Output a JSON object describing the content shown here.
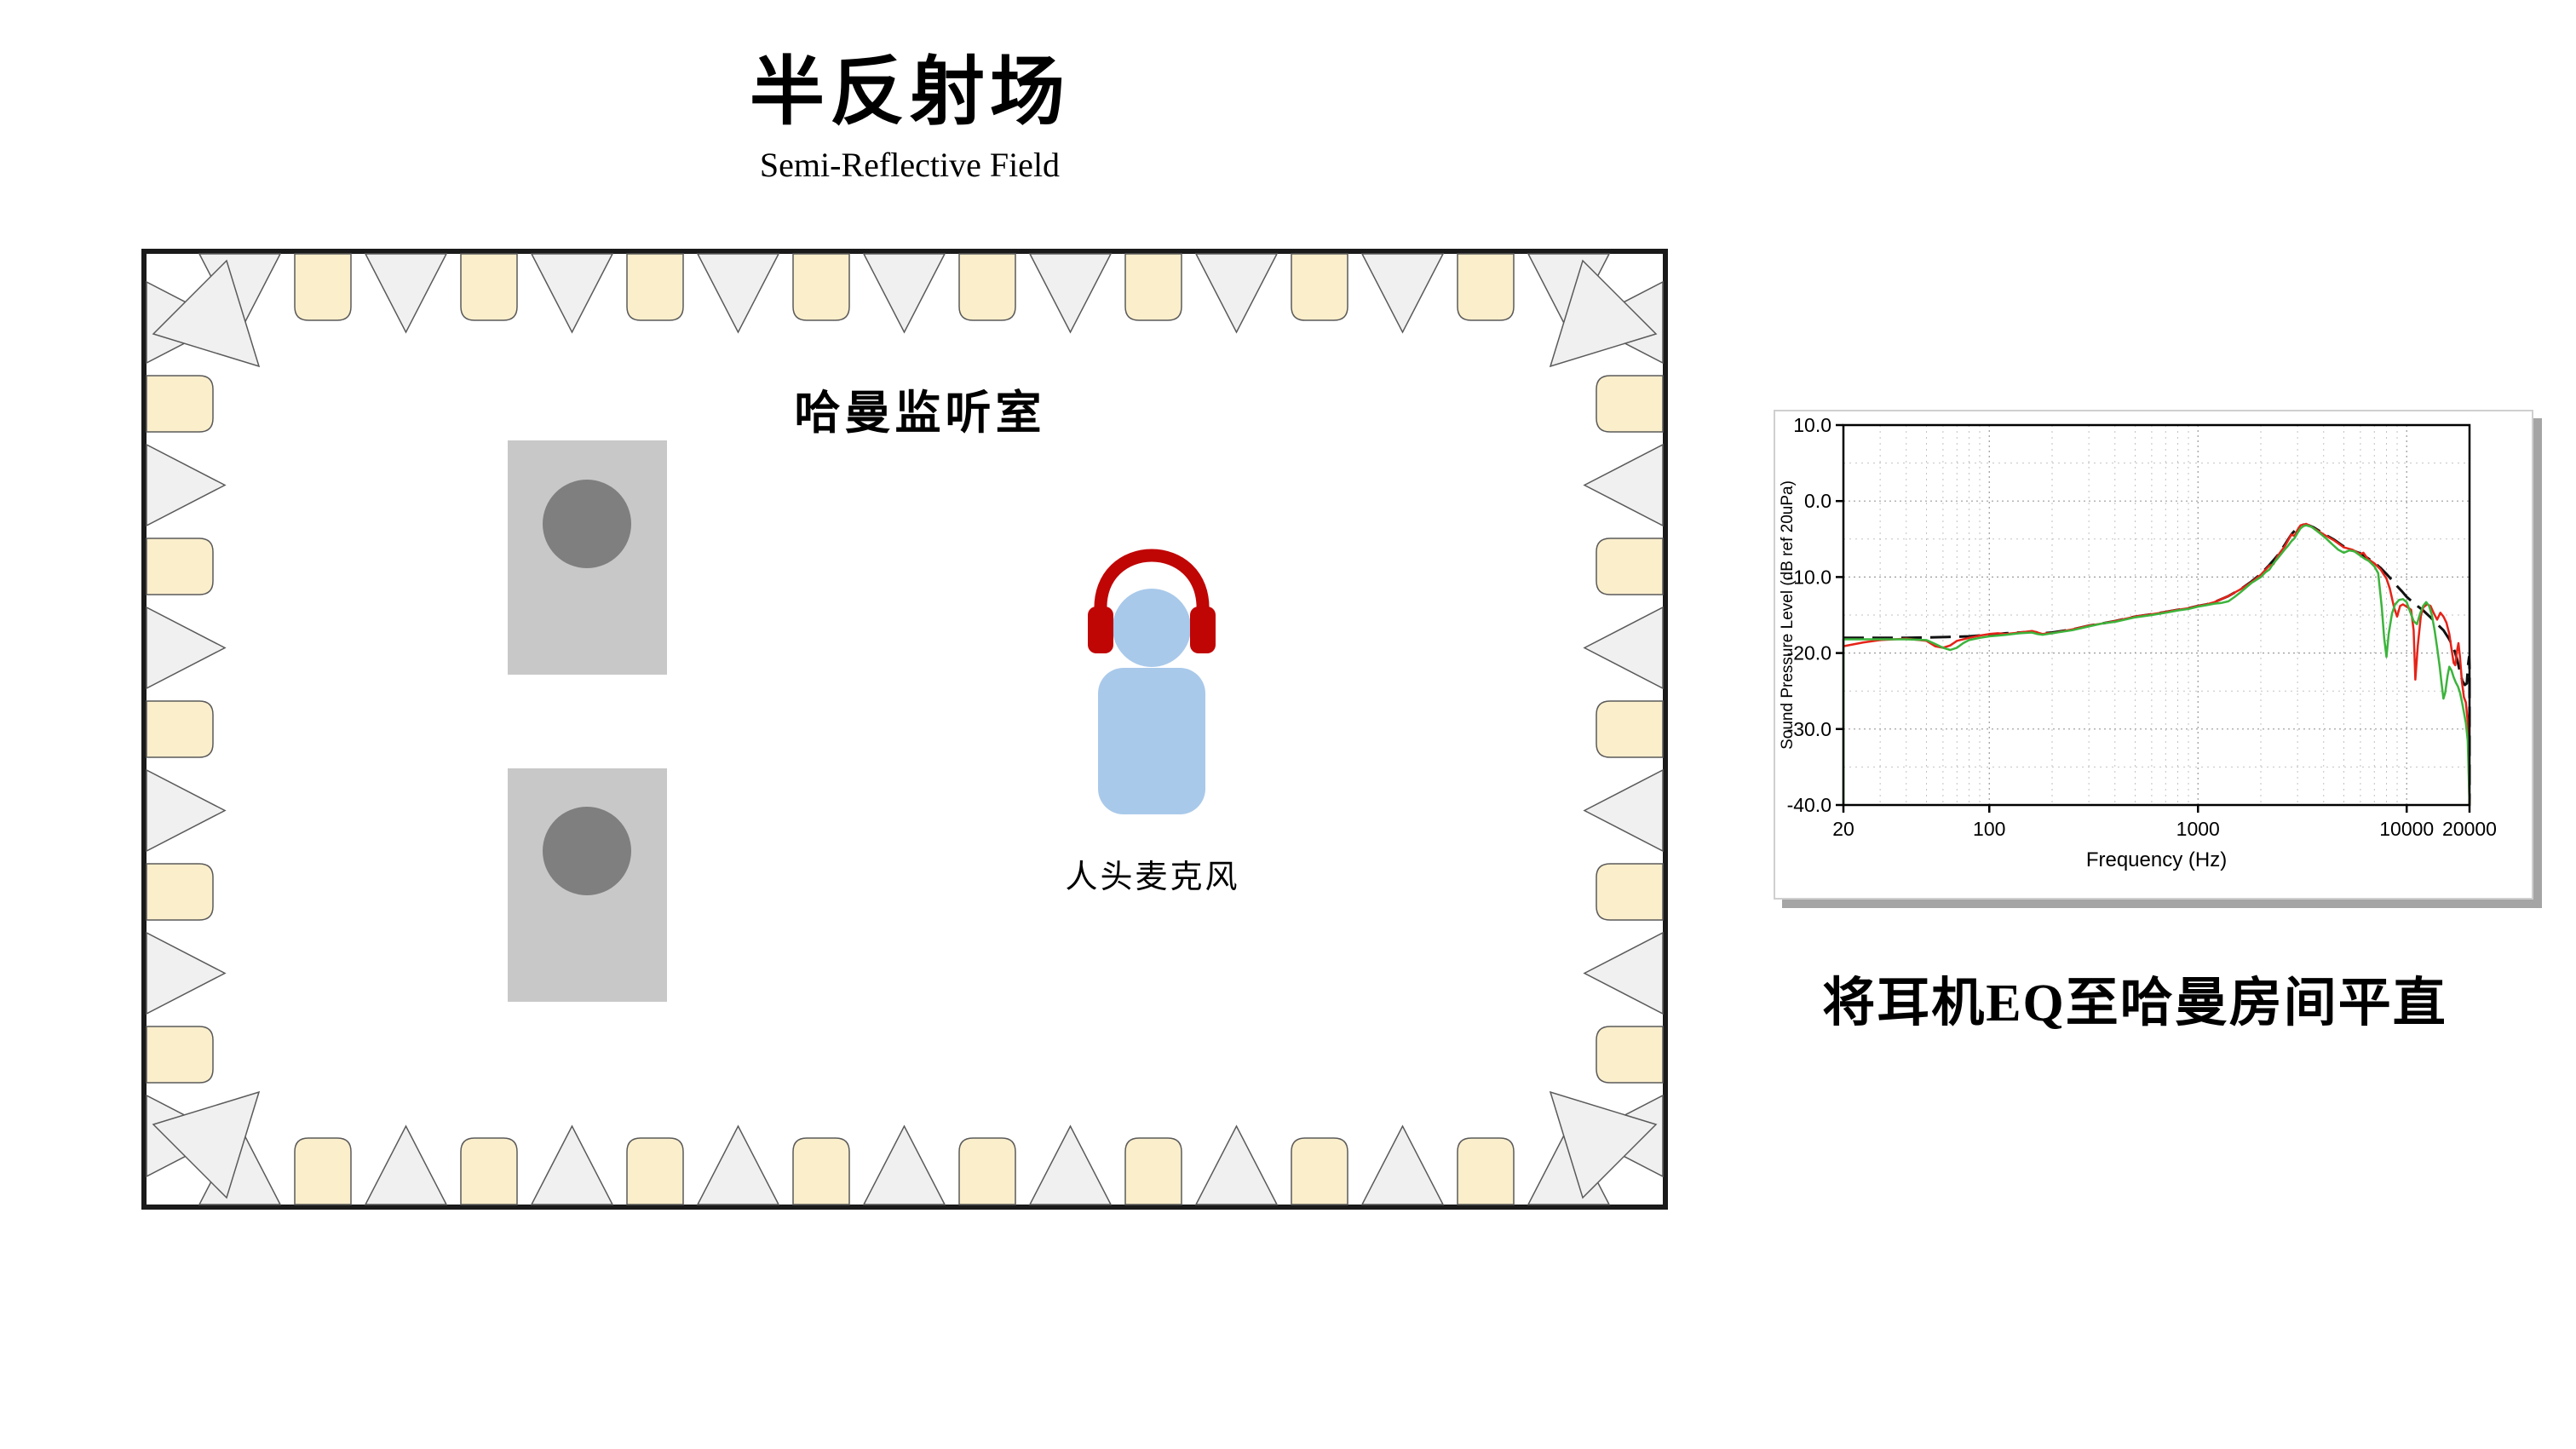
{
  "title": {
    "zh": "半反射场",
    "en": "Semi-Reflective Field"
  },
  "room": {
    "label": "哈曼监听室",
    "mic_label": "人头麦克风",
    "speaker_count": 2,
    "treatment": {
      "top_wedges": 9,
      "top_absorbers": 8,
      "bottom_wedges": 9,
      "bottom_absorbers": 8,
      "left_wedges": 6,
      "left_absorbers": 5,
      "right_wedges": 6,
      "right_absorbers": 5,
      "corner_wedges": 4
    },
    "colors": {
      "wall": "#1a1a1a",
      "wedge_fill": "#f0f0f0",
      "wedge_stroke": "#5a5a5a",
      "absorber_fill": "#fbeecb",
      "speaker_body": "#c8c8c8",
      "speaker_cone": "#7f7f7f",
      "person_blue": "#a9c9ea",
      "headphone_red": "#c00505"
    }
  },
  "chart_caption": "将耳机EQ至哈曼房间平直",
  "chart_data": {
    "type": "line",
    "title": "",
    "xlabel": "Frequency (Hz)",
    "ylabel": "Sound Pressure Level (dB ref 20uPa)",
    "x_scale": "log",
    "xlim": [
      20,
      20000
    ],
    "ylim": [
      -40,
      10
    ],
    "xtick_values": [
      20,
      100,
      1000,
      10000,
      20000
    ],
    "xtick_labels": [
      "20",
      "100",
      "1000",
      "10000",
      "20000"
    ],
    "ytick_values": [
      10,
      0,
      -10,
      -20,
      -30,
      -40
    ],
    "ytick_labels": [
      "10.0",
      "0.0",
      "-10.0",
      "-20.0",
      "-30.0",
      "-40.0"
    ],
    "grid": true,
    "legend": false,
    "series": [
      {
        "name": "target-black-dashed",
        "color": "#111111",
        "style": "dashed",
        "width": 3,
        "points": [
          [
            20,
            -18
          ],
          [
            40,
            -18
          ],
          [
            60,
            -17.9
          ],
          [
            80,
            -17.8
          ],
          [
            100,
            -17.6
          ],
          [
            120,
            -17.4
          ],
          [
            140,
            -17.3
          ],
          [
            160,
            -17.2
          ],
          [
            180,
            -17.4
          ],
          [
            200,
            -17.3
          ],
          [
            250,
            -16.9
          ],
          [
            300,
            -16.4
          ],
          [
            350,
            -16.1
          ],
          [
            400,
            -15.8
          ],
          [
            500,
            -15.2
          ],
          [
            600,
            -14.9
          ],
          [
            700,
            -14.6
          ],
          [
            800,
            -14.3
          ],
          [
            900,
            -14.1
          ],
          [
            1000,
            -13.8
          ],
          [
            1100,
            -13.6
          ],
          [
            1200,
            -13.3
          ],
          [
            1400,
            -12.5
          ],
          [
            1600,
            -11.6
          ],
          [
            1800,
            -10.6
          ],
          [
            2000,
            -9.6
          ],
          [
            2200,
            -8.4
          ],
          [
            2400,
            -7.2
          ],
          [
            2600,
            -5.8
          ],
          [
            2800,
            -4.4
          ],
          [
            3000,
            -3.5
          ],
          [
            3200,
            -3.1
          ],
          [
            3400,
            -3.2
          ],
          [
            3600,
            -3.5
          ],
          [
            3800,
            -3.9
          ],
          [
            4000,
            -4.3
          ],
          [
            4500,
            -5.1
          ],
          [
            5000,
            -6
          ],
          [
            5500,
            -6.5
          ],
          [
            6000,
            -6.9
          ],
          [
            6500,
            -7.5
          ],
          [
            7000,
            -8.1
          ],
          [
            7500,
            -8.8
          ],
          [
            8000,
            -9.6
          ],
          [
            8500,
            -10.4
          ],
          [
            9000,
            -11.2
          ],
          [
            9500,
            -11.9
          ],
          [
            10000,
            -12.6
          ],
          [
            11000,
            -13.6
          ],
          [
            12000,
            -14.4
          ],
          [
            13000,
            -15.3
          ],
          [
            14000,
            -16.2
          ],
          [
            15000,
            -17
          ],
          [
            16000,
            -18.2
          ],
          [
            17000,
            -19.8
          ],
          [
            17500,
            -21
          ],
          [
            18000,
            -22.5
          ],
          [
            18500,
            -23.7
          ],
          [
            19000,
            -24.2
          ],
          [
            19400,
            -24
          ],
          [
            19700,
            -21.5
          ],
          [
            19900,
            -20.5
          ],
          [
            20000,
            -22
          ],
          [
            20000,
            -40
          ]
        ]
      },
      {
        "name": "measured-red",
        "color": "#e52318",
        "style": "solid",
        "width": 2.5,
        "points": [
          [
            20,
            -19.1
          ],
          [
            25,
            -18.6
          ],
          [
            30,
            -18.3
          ],
          [
            40,
            -18.1
          ],
          [
            50,
            -18.4
          ],
          [
            55,
            -19.1
          ],
          [
            60,
            -19.3
          ],
          [
            65,
            -19
          ],
          [
            70,
            -18.4
          ],
          [
            80,
            -18
          ],
          [
            90,
            -17.7
          ],
          [
            100,
            -17.5
          ],
          [
            110,
            -17.4
          ],
          [
            120,
            -17.5
          ],
          [
            130,
            -17.4
          ],
          [
            140,
            -17.3
          ],
          [
            150,
            -17.2
          ],
          [
            160,
            -17.1
          ],
          [
            170,
            -17.3
          ],
          [
            180,
            -17.5
          ],
          [
            190,
            -17.4
          ],
          [
            200,
            -17.4
          ],
          [
            250,
            -16.9
          ],
          [
            300,
            -16.4
          ],
          [
            350,
            -16.1
          ],
          [
            400,
            -15.8
          ],
          [
            500,
            -15.2
          ],
          [
            600,
            -14.9
          ],
          [
            700,
            -14.6
          ],
          [
            800,
            -14.3
          ],
          [
            900,
            -14.1
          ],
          [
            1000,
            -13.8
          ],
          [
            1100,
            -13.6
          ],
          [
            1200,
            -13.3
          ],
          [
            1400,
            -12.5
          ],
          [
            1600,
            -11.6
          ],
          [
            1800,
            -10.7
          ],
          [
            2000,
            -9.7
          ],
          [
            2200,
            -8.5
          ],
          [
            2300,
            -8.3
          ],
          [
            2400,
            -7.3
          ],
          [
            2500,
            -6.6
          ],
          [
            2600,
            -6
          ],
          [
            2700,
            -5.2
          ],
          [
            2800,
            -4.4
          ],
          [
            2900,
            -4.6
          ],
          [
            3000,
            -3.8
          ],
          [
            3100,
            -3.2
          ],
          [
            3200,
            -3.1
          ],
          [
            3300,
            -3
          ],
          [
            3400,
            -3.2
          ],
          [
            3600,
            -3.6
          ],
          [
            3800,
            -4
          ],
          [
            4000,
            -4.4
          ],
          [
            4500,
            -5.2
          ],
          [
            5000,
            -6.1
          ],
          [
            5500,
            -6.4
          ],
          [
            6000,
            -7
          ],
          [
            6200,
            -6.8
          ],
          [
            6500,
            -7.6
          ],
          [
            7000,
            -8.2
          ],
          [
            7500,
            -9
          ],
          [
            8000,
            -10.2
          ],
          [
            8300,
            -11.5
          ],
          [
            8700,
            -14
          ],
          [
            9000,
            -15.2
          ],
          [
            9300,
            -13.8
          ],
          [
            9600,
            -13.6
          ],
          [
            10000,
            -13.9
          ],
          [
            10500,
            -14.3
          ],
          [
            10800,
            -17
          ],
          [
            11000,
            -23.5
          ],
          [
            11300,
            -19
          ],
          [
            11700,
            -15
          ],
          [
            12000,
            -14
          ],
          [
            12500,
            -13.6
          ],
          [
            13000,
            -13.8
          ],
          [
            13500,
            -14.8
          ],
          [
            14000,
            -15.6
          ],
          [
            14500,
            -14.7
          ],
          [
            15000,
            -15.2
          ],
          [
            15500,
            -16
          ],
          [
            16000,
            -17.5
          ],
          [
            16400,
            -19.5
          ],
          [
            16800,
            -21.3
          ],
          [
            17100,
            -21.6
          ],
          [
            17400,
            -19.8
          ],
          [
            17700,
            -18.7
          ],
          [
            18000,
            -20.5
          ],
          [
            18400,
            -23.8
          ],
          [
            18800,
            -25.8
          ],
          [
            19200,
            -26.5
          ],
          [
            19600,
            -29
          ],
          [
            20000,
            -40
          ]
        ]
      },
      {
        "name": "measured-green",
        "color": "#3cb43c",
        "style": "solid",
        "width": 2.5,
        "points": [
          [
            20,
            -40
          ],
          [
            20,
            -18.2
          ],
          [
            30,
            -18.2
          ],
          [
            40,
            -18.2
          ],
          [
            50,
            -18.3
          ],
          [
            55,
            -18.8
          ],
          [
            60,
            -19.3
          ],
          [
            65,
            -19.6
          ],
          [
            70,
            -19.3
          ],
          [
            75,
            -18.7
          ],
          [
            80,
            -18.3
          ],
          [
            90,
            -18
          ],
          [
            100,
            -17.8
          ],
          [
            110,
            -17.7
          ],
          [
            120,
            -17.6
          ],
          [
            140,
            -17.4
          ],
          [
            160,
            -17.3
          ],
          [
            170,
            -17.5
          ],
          [
            180,
            -17.6
          ],
          [
            190,
            -17.5
          ],
          [
            200,
            -17.4
          ],
          [
            250,
            -17
          ],
          [
            300,
            -16.5
          ],
          [
            350,
            -16.1
          ],
          [
            400,
            -15.9
          ],
          [
            500,
            -15.3
          ],
          [
            600,
            -15
          ],
          [
            700,
            -14.7
          ],
          [
            800,
            -14.4
          ],
          [
            900,
            -14.2
          ],
          [
            1000,
            -13.9
          ],
          [
            1100,
            -13.7
          ],
          [
            1200,
            -13.5
          ],
          [
            1300,
            -13.4
          ],
          [
            1400,
            -13.2
          ],
          [
            1500,
            -12.6
          ],
          [
            1600,
            -12
          ],
          [
            1800,
            -10.8
          ],
          [
            2000,
            -10
          ],
          [
            2100,
            -9.4
          ],
          [
            2200,
            -9
          ],
          [
            2300,
            -8.2
          ],
          [
            2400,
            -7.6
          ],
          [
            2500,
            -7
          ],
          [
            2600,
            -6.4
          ],
          [
            2700,
            -5.9
          ],
          [
            2800,
            -5.3
          ],
          [
            2900,
            -4.9
          ],
          [
            3000,
            -4.2
          ],
          [
            3100,
            -3.6
          ],
          [
            3200,
            -3.3
          ],
          [
            3300,
            -3.2
          ],
          [
            3500,
            -3.4
          ],
          [
            3700,
            -3.9
          ],
          [
            3900,
            -4.4
          ],
          [
            4100,
            -4.9
          ],
          [
            4400,
            -5.7
          ],
          [
            4700,
            -6.4
          ],
          [
            5000,
            -6.8
          ],
          [
            5300,
            -6.5
          ],
          [
            5600,
            -6.6
          ],
          [
            6000,
            -7.2
          ],
          [
            6300,
            -7.6
          ],
          [
            6600,
            -7.9
          ],
          [
            7000,
            -8.6
          ],
          [
            7300,
            -9.5
          ],
          [
            7600,
            -14
          ],
          [
            7800,
            -18
          ],
          [
            8000,
            -20.5
          ],
          [
            8200,
            -17.5
          ],
          [
            8500,
            -14.8
          ],
          [
            8800,
            -13.6
          ],
          [
            9200,
            -13
          ],
          [
            9600,
            -12.9
          ],
          [
            10000,
            -13.3
          ],
          [
            10400,
            -14.6
          ],
          [
            10800,
            -15.8
          ],
          [
            11200,
            -16.2
          ],
          [
            11600,
            -14.8
          ],
          [
            12000,
            -13.8
          ],
          [
            12400,
            -13.3
          ],
          [
            12800,
            -13.8
          ],
          [
            13200,
            -15
          ],
          [
            13600,
            -17
          ],
          [
            14000,
            -19.3
          ],
          [
            14400,
            -21.8
          ],
          [
            14700,
            -24
          ],
          [
            15000,
            -26
          ],
          [
            15300,
            -25.2
          ],
          [
            15700,
            -23
          ],
          [
            16000,
            -21.8
          ],
          [
            16400,
            -22.3
          ],
          [
            16800,
            -23.2
          ],
          [
            17200,
            -23.9
          ],
          [
            17600,
            -24.4
          ],
          [
            18000,
            -25.2
          ],
          [
            18400,
            -26.4
          ],
          [
            18800,
            -27.8
          ],
          [
            19200,
            -29.2
          ],
          [
            19600,
            -31.5
          ],
          [
            20000,
            -40
          ]
        ]
      }
    ]
  }
}
